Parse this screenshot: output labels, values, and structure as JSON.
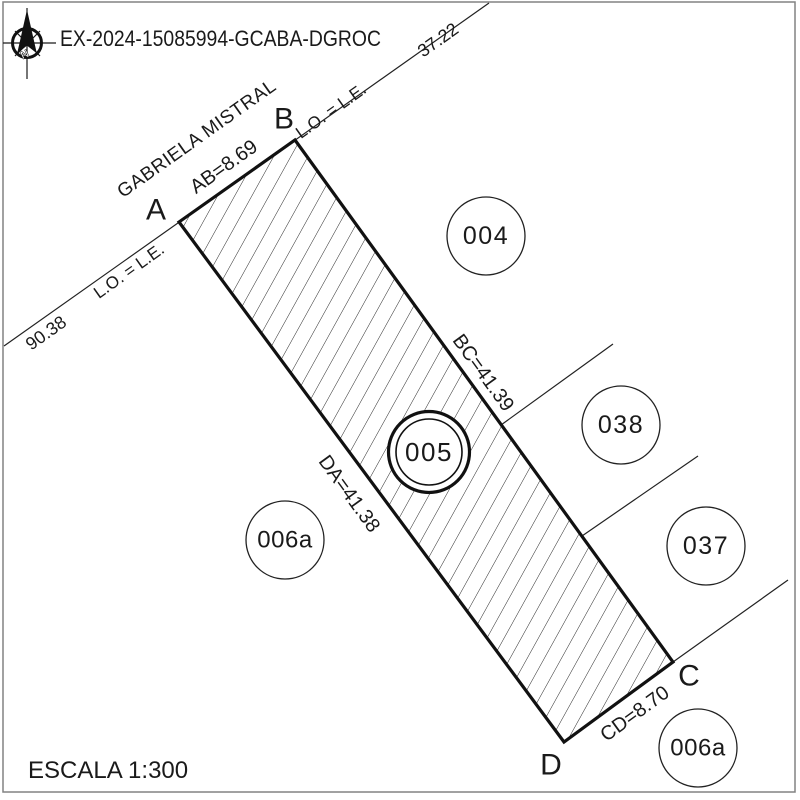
{
  "colors": {
    "ink": "#1a1a1a",
    "thick_line": "#111111",
    "thin_line": "#222222",
    "page_border": "#828282",
    "background": "#ffffff"
  },
  "header": {
    "file_number": "EX-2024-15085994-GCABA-DGROC",
    "north_letter": "N"
  },
  "footer": {
    "scale_label": "ESCALA 1:300"
  },
  "plan": {
    "street_name": "GABRIELA MISTRAL",
    "street_dims": {
      "upper": "37.22",
      "lower": "90.38"
    },
    "alignment": {
      "upper": "L.O. = L.E.",
      "lower": "L.O. = L.E."
    },
    "corners": {
      "a": "A",
      "b": "B",
      "c": "C",
      "d": "D"
    },
    "sides": {
      "ab": "AB=8.69",
      "bc": "BC=41.39",
      "cd": "CD=8.70",
      "da": "DA=41.38"
    },
    "parcels": {
      "subject": "005",
      "p004": "004",
      "p038": "038",
      "p037": "037",
      "p006a_west": "006a",
      "p006a_south": "006a"
    }
  }
}
